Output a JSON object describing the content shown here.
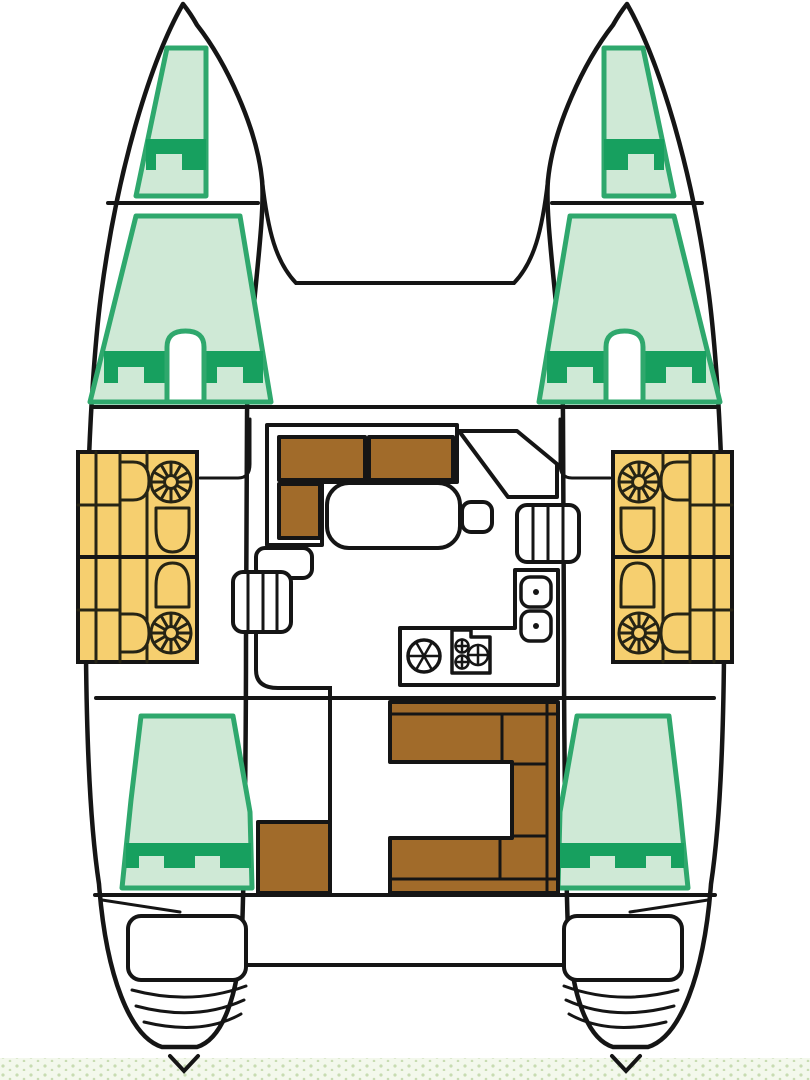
{
  "diagram": {
    "title": "catamaran-deck-floor-plan",
    "view": "top-down",
    "hull_count": 2,
    "berth_count": 6,
    "bathroom_count": 4,
    "sections": {
      "bow": [
        "port-forepeak-berth",
        "starboard-forepeak-berth"
      ],
      "forward": [
        "foredeck",
        "port-forward-double-berth",
        "starboard-forward-double-berth"
      ],
      "midship": [
        "port-bathrooms",
        "starboard-bathrooms",
        "salon-settee",
        "salon-table",
        "stool-seat",
        "nav-console",
        "port-steps",
        "starboard-steps",
        "galley"
      ],
      "aft": [
        "port-aft-double-berth",
        "starboard-aft-double-berth",
        "cockpit-u-bench",
        "cockpit-storage-box"
      ],
      "stern": [
        "port-swim-platform",
        "starboard-swim-platform"
      ]
    },
    "fixtures": {
      "shower_roses": 4,
      "toilets": 4,
      "washbasins": 4,
      "galley_sinks": 2,
      "stove_burners": 3,
      "round_basin": 1,
      "step_treads_per_stair": 4
    }
  },
  "colors": {
    "outline": "#151515",
    "bed_fill": "#cfe9d6",
    "bed_border": "#2fa86d",
    "pillow_green": "#17a05f",
    "bathroom_yellow": "#f6cf6f",
    "fixture_line": "#262415",
    "wood_brown": "#a16b2a",
    "water_base": "#f3f8ec",
    "water_dot": "#c8dcb2",
    "paper": "#ffffff"
  }
}
